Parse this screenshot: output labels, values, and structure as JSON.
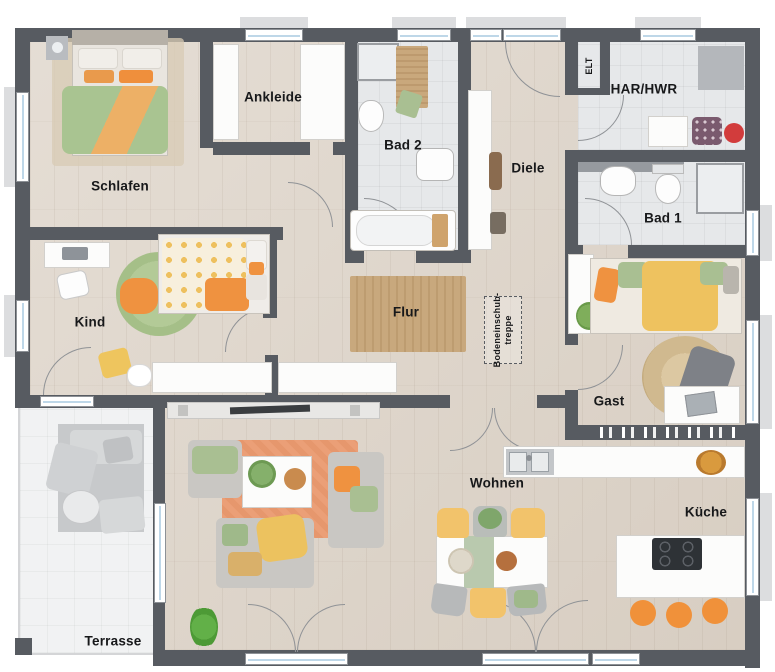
{
  "rooms": {
    "schlafen": {
      "label": "Schlafen"
    },
    "ankleide": {
      "label": "Ankleide"
    },
    "bad2": {
      "label": "Bad 2"
    },
    "diele": {
      "label": "Diele"
    },
    "elt": {
      "label": "ELT"
    },
    "har_hwr": {
      "label": "HAR/HWR"
    },
    "bad1": {
      "label": "Bad 1"
    },
    "kind": {
      "label": "Kind"
    },
    "flur": {
      "label": "Flur"
    },
    "bodeneinschubtreppe": {
      "label": "Bodeneinschub-\ntreppe"
    },
    "gast": {
      "label": "Gast"
    },
    "wohnen": {
      "label": "Wohnen"
    },
    "kueche": {
      "label": "Küche"
    },
    "terrasse": {
      "label": "Terrasse"
    }
  },
  "colors": {
    "wall": "#575b61",
    "floor_wood": "#dcd2c6",
    "floor_tile": "#e6e8ea",
    "terrace": "#f1f2f3",
    "window_glass": "#bed7e8",
    "accent_orange": "#f0913a",
    "accent_yellow": "#eec25f",
    "accent_green": "#a9c491",
    "rug_jute": "#c8a87d",
    "rug_living": "#eb9f77",
    "label_text": "#17181a"
  }
}
